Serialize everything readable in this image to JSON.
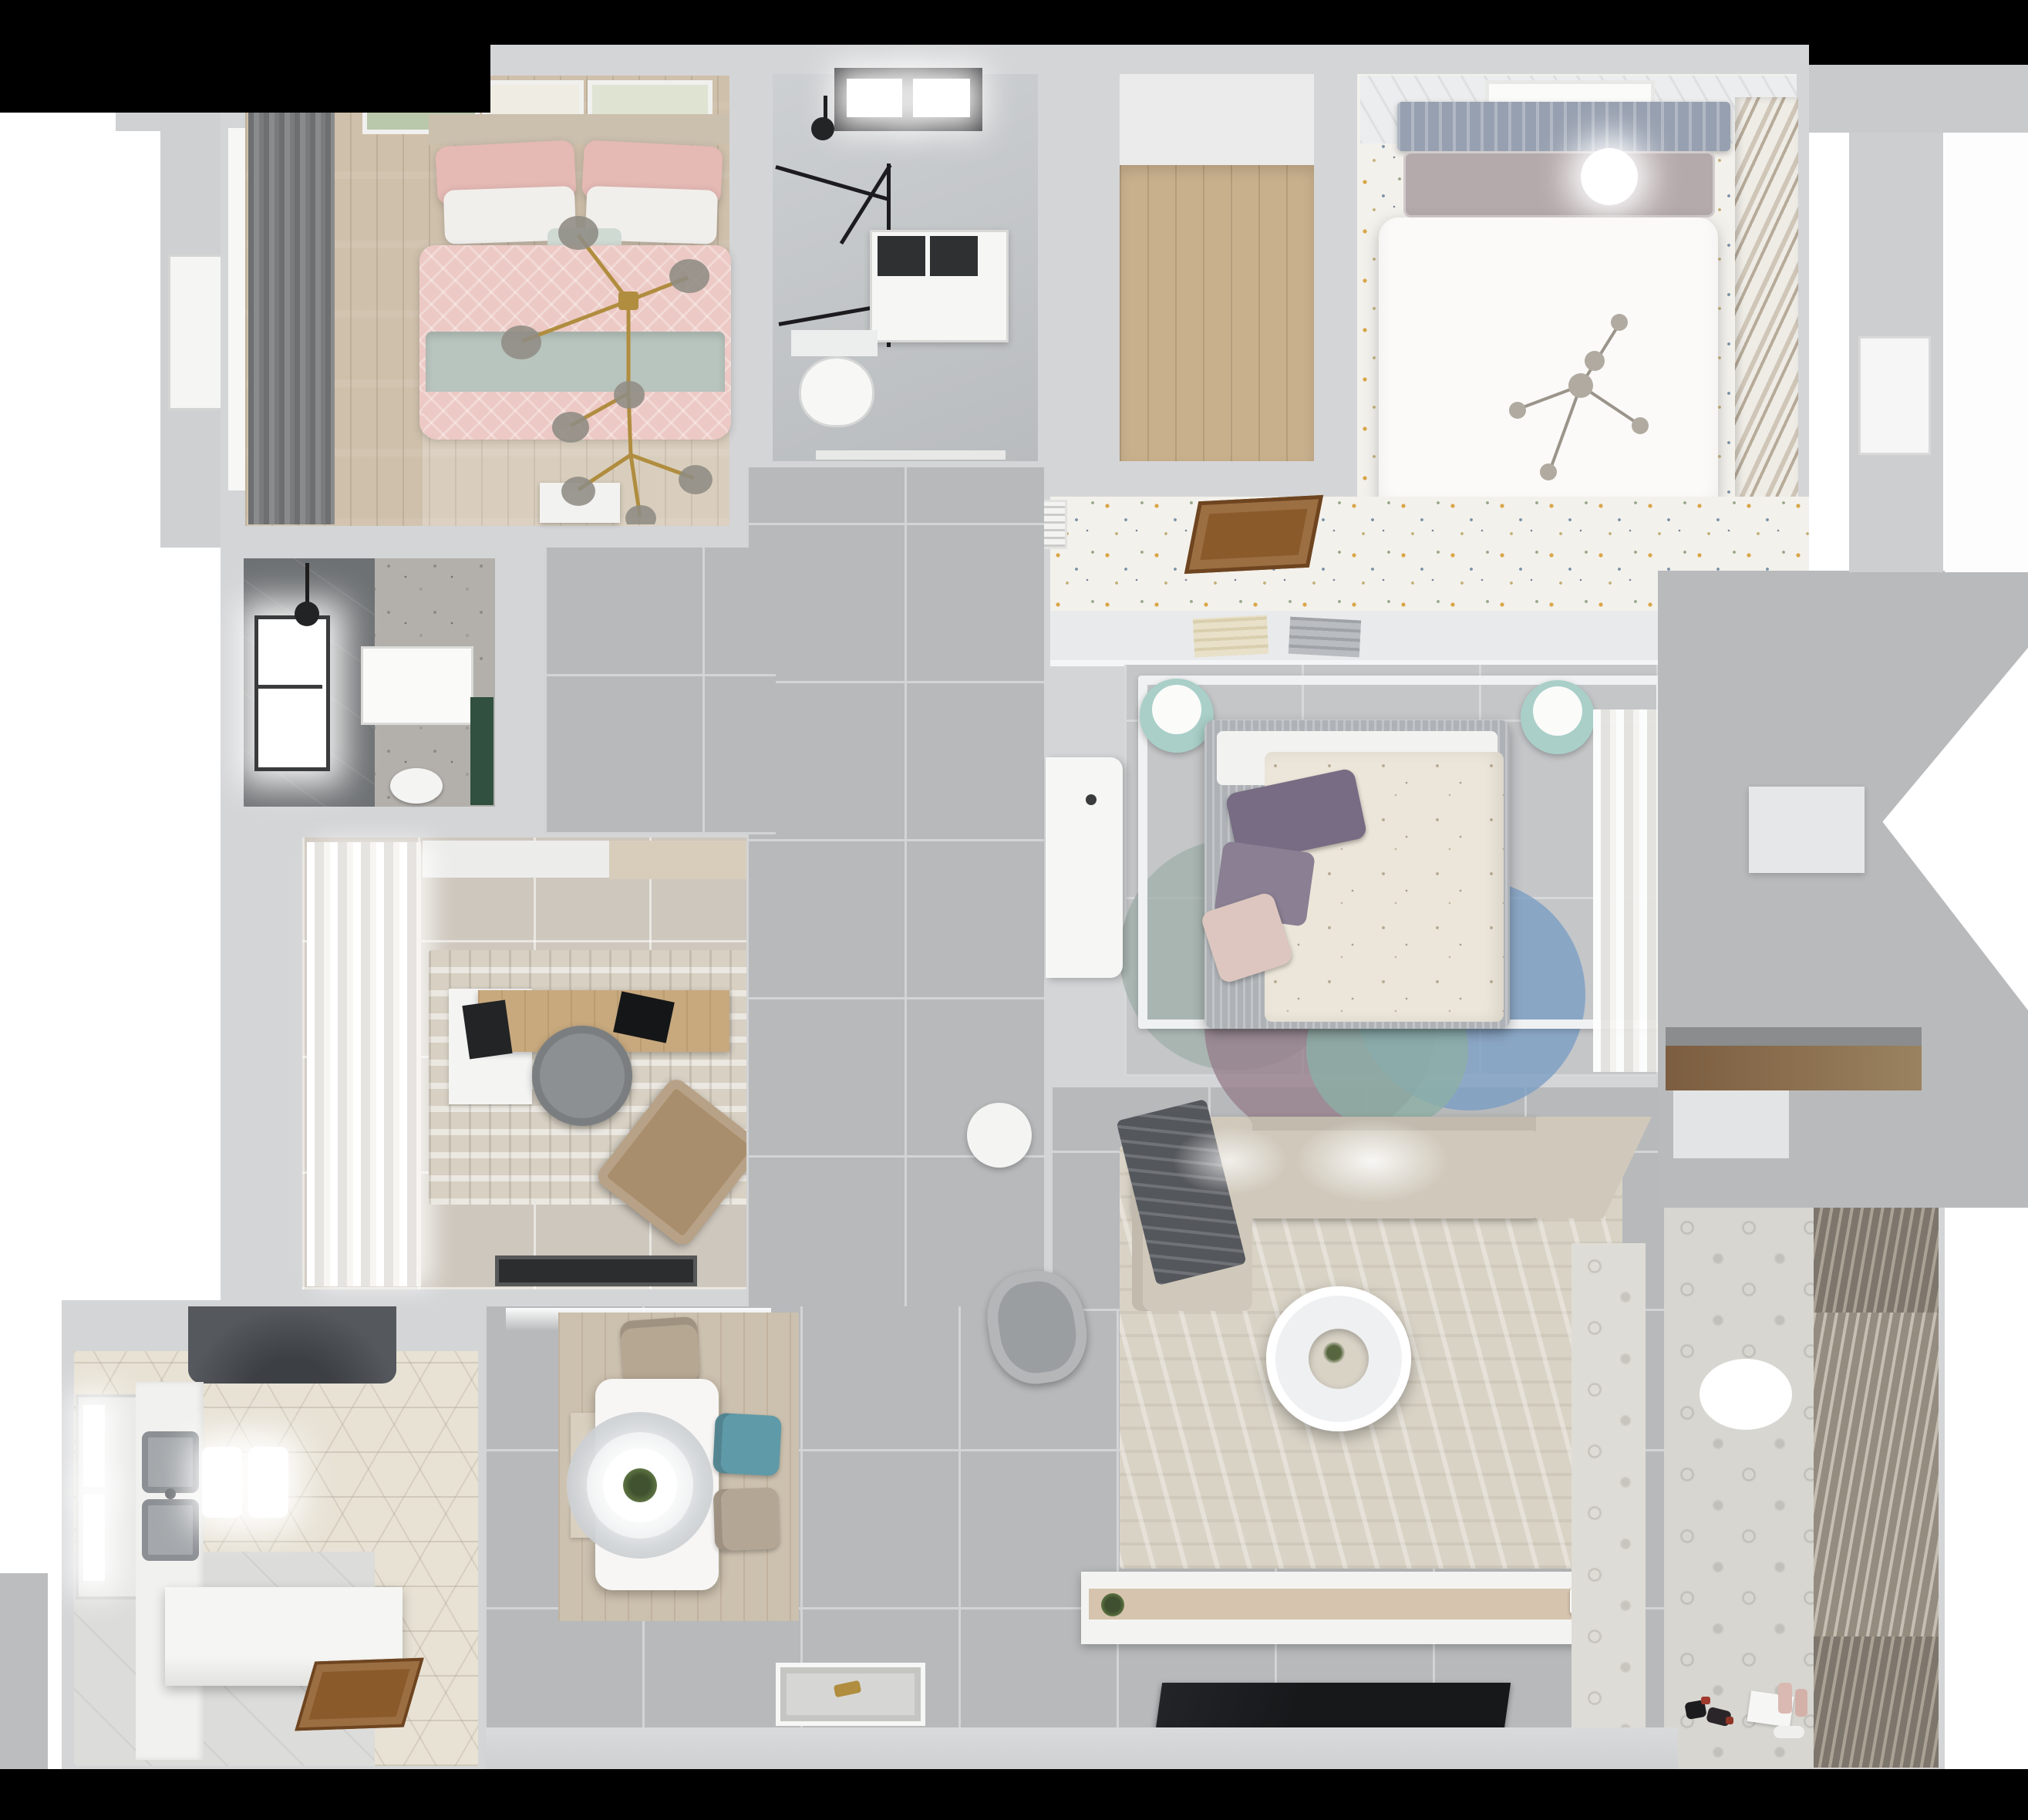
{
  "scene": {
    "title": "Top-down 3D dollhouse render of a three-bedroom apartment floor plan",
    "view": "orthographic top view, no visible text or UI controls"
  },
  "palette": {
    "bg": "#ffffff",
    "mask": "#000000",
    "wall": "#d4d5d7",
    "wall-deep": "#c6c7c9",
    "outside": "#b9babc",
    "tile": "#b7b9bb",
    "grout": "#d2d4d6",
    "tile-light": "#c4c6c8",
    "grout-light": "#d6d8da",
    "wood-light": "#cfc0ab",
    "wood-mid": "#c9b08d",
    "wood-door": "#8b5a2b",
    "pink": "#ecc9c4",
    "pink-deep": "#e5b9b4",
    "sage": "#b8c4be",
    "curtain-dark": "#77787a",
    "headboard": "#97a0b0",
    "speckle-base": "#f3f1ec",
    "amber": "#d9a648",
    "bluegray": "#7d94a8",
    "terrazzo": "#b3b0ac",
    "shower-dark": "#6e7173",
    "green-dark": "#31503f",
    "study-floor": "#cec7bd",
    "rug-beige": "#d9d3c6",
    "teal-chair": "#5f9aa8",
    "chair-beige": "#b5a792",
    "mint": "#a9cfc8",
    "purple": "#776c83",
    "blue-rug": "#7fa3c4",
    "mauve-rug": "#9b8490",
    "tealrug": "#93b0a9",
    "sofa": "#d0c9bb",
    "blanket": "#54575c",
    "hex-base": "#e8e2d5",
    "hood": "#55595e",
    "steel": "#a4a8ac",
    "balcony-tile": "#d7d6d1",
    "blind": "#958c80",
    "blind-dark": "#7d766c",
    "tv": "#17181a",
    "gold": "#b08d3f"
  },
  "rooms": [
    {
      "id": "bedroom-secondary",
      "name": "Secondary bedroom",
      "position": "top-left",
      "floor": "light wood planks",
      "furniture": [
        "double bed with blush-pink patterned bedding",
        "sage green throw band",
        "white and pink pillows",
        "gold branch chandelier with smoked-glass globes",
        "dark roman blind / curtain wall with window",
        "three botanical wall-art frames",
        "white dresser at foot wall"
      ]
    },
    {
      "id": "bathroom-main",
      "name": "Main bathroom",
      "position": "top-middle",
      "floor": "grey marble tile",
      "furniture": [
        "black skylight window",
        "black-framed glass shower partition",
        "black wall shower head",
        "white washer cabinet",
        "wall-hung toilet"
      ]
    },
    {
      "id": "walk-in-room",
      "name": "Empty walk-in room",
      "position": "top-center",
      "floor": "oak planks",
      "furniture": []
    },
    {
      "id": "bedroom-master",
      "name": "Master bedroom",
      "position": "top-right",
      "floor": "speckled floral carpet",
      "furniture": [
        "double bed with white duvet",
        "blue-grey ribbed headboard",
        "round white bedside lamp",
        "grey sprig chandelier",
        "framed botanical print",
        "diagonal louvered wardrobe",
        "slatted ceiling edge"
      ]
    },
    {
      "id": "hallway-master",
      "name": "Bedroom hallway",
      "position": "center-right-upper",
      "floor": "speckled floral carpet",
      "furniture": [
        "white louvered vent panel",
        "open walnut door"
      ]
    },
    {
      "id": "bathroom-shower",
      "name": "Shower bathroom",
      "position": "middle-left",
      "floor": "terrazzo",
      "furniture": [
        "dark grey tiled shower zone",
        "glowing window",
        "black shower head",
        "white shower tray",
        "toilet",
        "dark green ledge"
      ]
    },
    {
      "id": "study",
      "name": "Study",
      "position": "center-left",
      "floor": "beige ceramic tile",
      "furniture": [
        "white sheer curtain wall",
        "abstract beige rug",
        "oak desk with white return",
        "grey round swivel chair",
        "tan lounge chair",
        "black laptop",
        "black tablet",
        "black door mat",
        "white top cabinet band"
      ]
    },
    {
      "id": "kitchen",
      "name": "Kitchen",
      "position": "bottom-left",
      "floor": "patterned hexagon tile",
      "furniture": [
        "dark range hood",
        "double stainless-steel sink",
        "two glowing pendant lights",
        "white island counter",
        "casement window",
        "open walnut door",
        "white perimeter counter"
      ]
    },
    {
      "id": "dining",
      "name": "Dining area",
      "position": "bottom-center-left",
      "floor": "grey tile with wood plank rug",
      "furniture": [
        "white dining table",
        "ring ceiling lamp with green plant centerpiece",
        "beige head chair",
        "teal chair",
        "second beige chair",
        "wood bench"
      ]
    },
    {
      "id": "bedroom-third",
      "name": "Third bedroom",
      "position": "center",
      "floor": "light grey tile",
      "furniture": [
        "bed with ivory floral duvet",
        "plum pillows and pink cushion",
        "white canopy frame",
        "overlapping circle rug in blue, mauve and teal",
        "white desk",
        "two mint poufs with white trays",
        "bookshelf above headboard",
        "sheer curtain wardrobe"
      ]
    },
    {
      "id": "living",
      "name": "Living room",
      "position": "bottom-center-right",
      "floor": "grey tile",
      "furniture": [
        "L-shaped beige sofa with angled end",
        "charcoal throw blanket",
        "white ring coffee table with plant",
        "grey armchair",
        "white side table",
        "long TV console with plant and vase",
        "flat black TV panel on media wall",
        "patterned tile walkway strip"
      ]
    },
    {
      "id": "balcony",
      "name": "Balcony / utility",
      "position": "bottom-right",
      "floor": "patterned cement tile",
      "furniture": [
        "full-height slatted blinds",
        "white oval ceiling light",
        "scattered toys",
        "pink bottles",
        "white paper sheet"
      ]
    },
    {
      "id": "entry",
      "name": "Entry corridor",
      "position": "bottom-center",
      "floor": "grey tile",
      "furniture": [
        "embossed white door mat with gold keys",
        "niche cove light"
      ]
    }
  ],
  "exterior": {
    "top_edge": "black crop band",
    "bottom_edge": "black crop band",
    "left": "white backdrop, grey wall slabs, white exterior door",
    "right": "grey terrace zone with white cut shapes, wood storage niche, white exterior door"
  }
}
